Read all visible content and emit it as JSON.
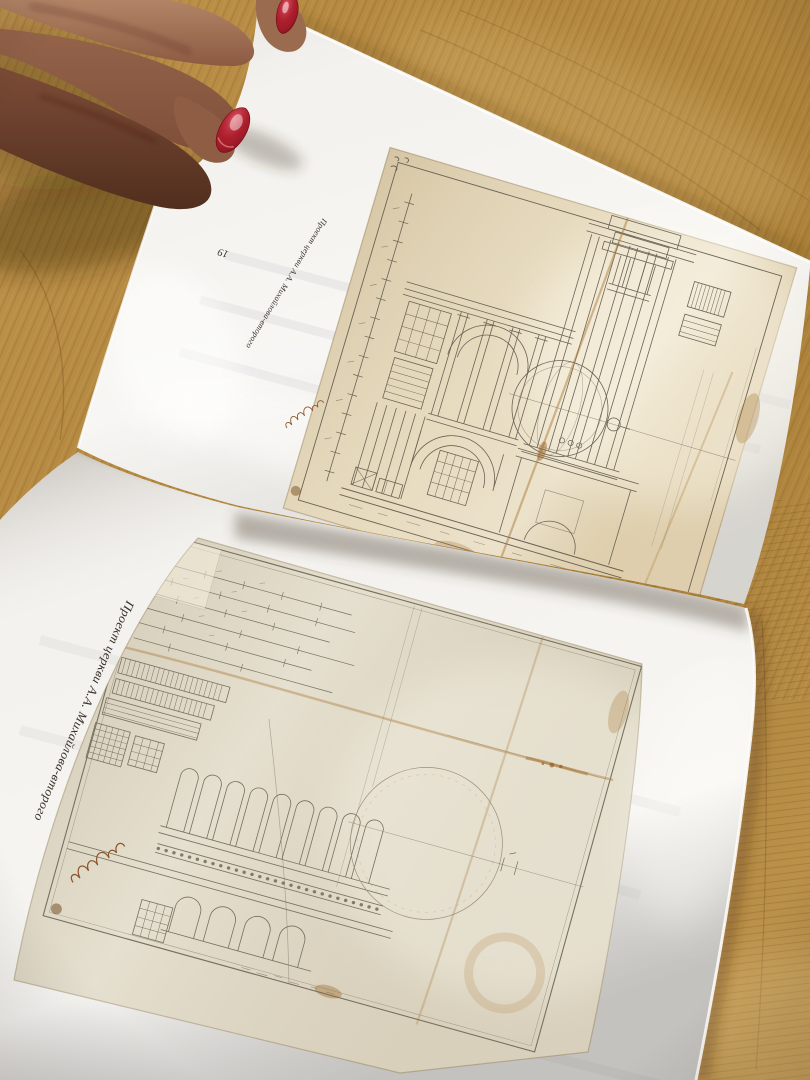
{
  "book": {
    "top_page": {
      "page_number": "19",
      "caption": "Проект церкви А.А. Михайлова-второго",
      "figure": "architectural-drawing-church-section-with-dome"
    },
    "bottom_page": {
      "caption": "Проект церкви А.А. Михайлова-второго",
      "figure": "architectural-drawing-church-elevation-with-dome"
    }
  },
  "colors": {
    "wood": "#b3873f",
    "page_white": "#f4f2ee",
    "aged_paper_top": "#e4d7ba",
    "aged_paper_bottom": "#ded7c5",
    "ink_line": "#6b6355",
    "ink_line_soft": "#76705f",
    "caption_ink": "#35302a",
    "stain_brown": "#a97a3a",
    "nail_polish_red": "#a61d2a",
    "skin_tone": "#8a5a44"
  }
}
